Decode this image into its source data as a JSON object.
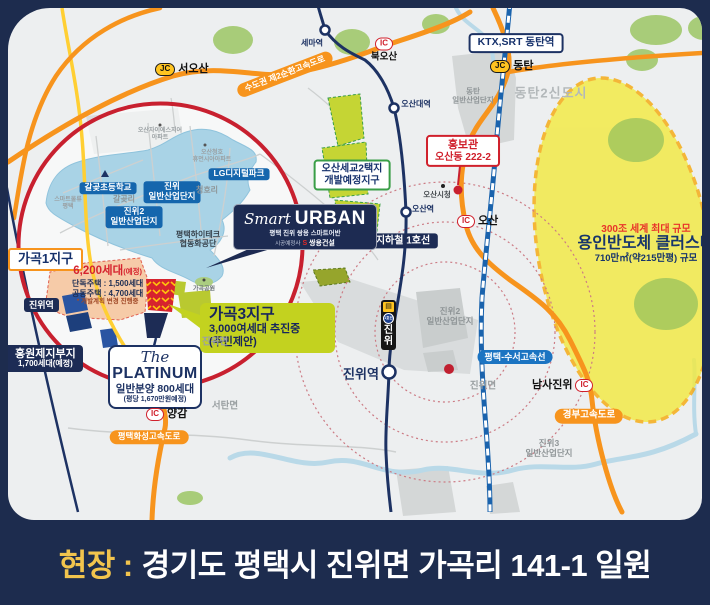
{
  "banner": {
    "prefix": "현장 :",
    "address": "경기도 평택시 진위면 가곡리 141-1 일원"
  },
  "legend_colors": {
    "highway_orange": "#f7941d",
    "rail_navy": "#1d3263",
    "site_red": "#c8202f",
    "zone_yellowgreen": "#c3d21f",
    "cluster_yellow": "#f3ea3e"
  },
  "junctions": {
    "jc": "JC",
    "ic": "IC",
    "seoosan": "서오산",
    "dongtan": "동탄",
    "bukosan": "북오산",
    "osan": "오산",
    "yanggam": "양감",
    "namsajinwi": "남사진위"
  },
  "roads": {
    "sudogwon2": "수도권 제2순환고속도로",
    "gyeongbu": "경부고속도로",
    "hwaseong": "평택화성고속도로",
    "suseo": "평택-수서고속선",
    "line1": "지하철 1호선"
  },
  "stations": {
    "sema": "세마역",
    "osandae": "오산대역",
    "osan": "오산역",
    "jinwi": "진위역",
    "jinwi_line_badge": "1호선",
    "jinwi_vertical": "진위"
  },
  "callouts": {
    "ktx": "KTX,SRT 동탄역",
    "hongbogwan": {
      "title": "홍보관",
      "address": "오산동 222-2"
    },
    "osan_segyo": {
      "line1": "오산세교2택지",
      "line2": "개발예정지구"
    },
    "smart_urban": {
      "script": "Smart",
      "brand": "URBAN",
      "subtitle": "평택 진위 쌍용 스마트어반",
      "builder_prefix": "시공예정사",
      "builder_logo": "S",
      "builder": "쌍용건설"
    },
    "gagok1": "가곡1지구",
    "gagok3": {
      "title": "가곡3지구",
      "line1": "3,000여세대 추진중",
      "line2": "(주민제안)"
    },
    "units6200": {
      "main": "6,200세대",
      "tag": "(예정)",
      "detached": "단독주택 : 1,500세대",
      "apartment": "공동주택 : 4,700세대",
      "note": "* 개발계획 변경 진행중"
    },
    "platinum": {
      "the": "The",
      "name": "PLATINUM",
      "line1": "일반분양 800세대",
      "line2": "(평당 1,670만원예정)"
    },
    "jinwi_station_zone": "진위역",
    "hongwon": {
      "line1": "홍원제지부지",
      "line2": "1,700세대(예정)"
    },
    "yongin": {
      "line1": "300조 세계 최대 규모",
      "line2": "용인반도체 클러스터",
      "line3": "710만㎡(약215만평) 규모"
    }
  },
  "places": {
    "dongtan2": "동탄2신도시",
    "industrial": "일반산업단지",
    "dongtan": "동탄",
    "osan_cityhall": "오산시청",
    "lg": "LG디지털파크",
    "galgot_school": "갈곶초등학교",
    "galgotri": "갈곶리",
    "jinwi": "진위",
    "jinwi2": "진위2",
    "jinwi3": "진위3",
    "cheonghori": "청호리",
    "hitech1": "평택하이테크",
    "hitech2": "협동화공단",
    "apt1a": "오산자이에스지어",
    "apt1b": "아파트",
    "apt2a": "오산청호",
    "apt2b": "휴먼시아아파트",
    "apt3a": "스마트물류",
    "apt3b": "평택",
    "gagok_park": "가곡공원",
    "jinwimyeon": "진위면",
    "seotanmyeon": "서탄면"
  }
}
